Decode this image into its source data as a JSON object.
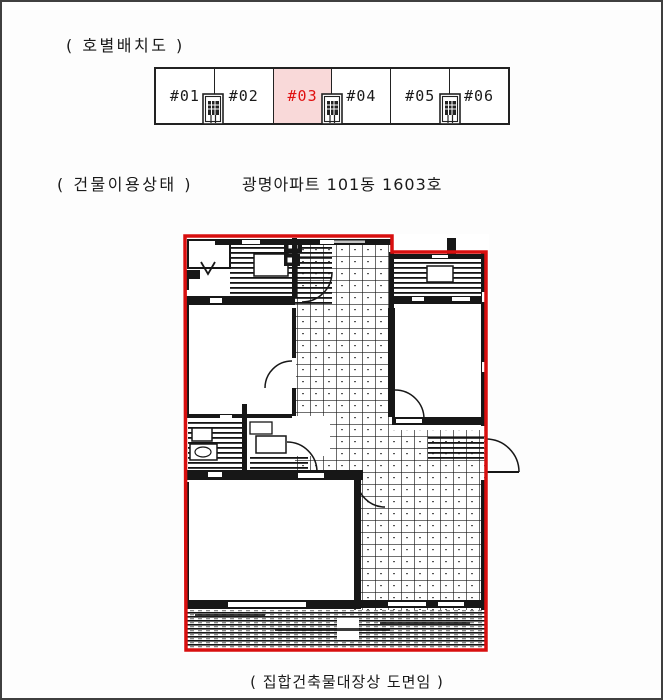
{
  "colors": {
    "page-border": "#3f3f3f",
    "ink": "#1a1a1a",
    "wall": "#171717",
    "accent-red": "#e01010",
    "highlight-bg": "#f9d9d9",
    "plan-red": "#d80f0f"
  },
  "unit_layout": {
    "title": "( 호별배치도 )",
    "highlighted_unit": "#03",
    "units": [
      {
        "label": "#01",
        "highlighted": false
      },
      {
        "label": "#02",
        "highlighted": false
      },
      {
        "label": "#03",
        "highlighted": true
      },
      {
        "label": "#04",
        "highlighted": false
      },
      {
        "label": "#05",
        "highlighted": false
      },
      {
        "label": "#06",
        "highlighted": false
      }
    ]
  },
  "usage": {
    "label": "( 건물이용상태 )",
    "value": "광명아파트 101동 1603호"
  },
  "floorplan": {
    "caption": "( 집합건축물대장상 도면임 )"
  }
}
